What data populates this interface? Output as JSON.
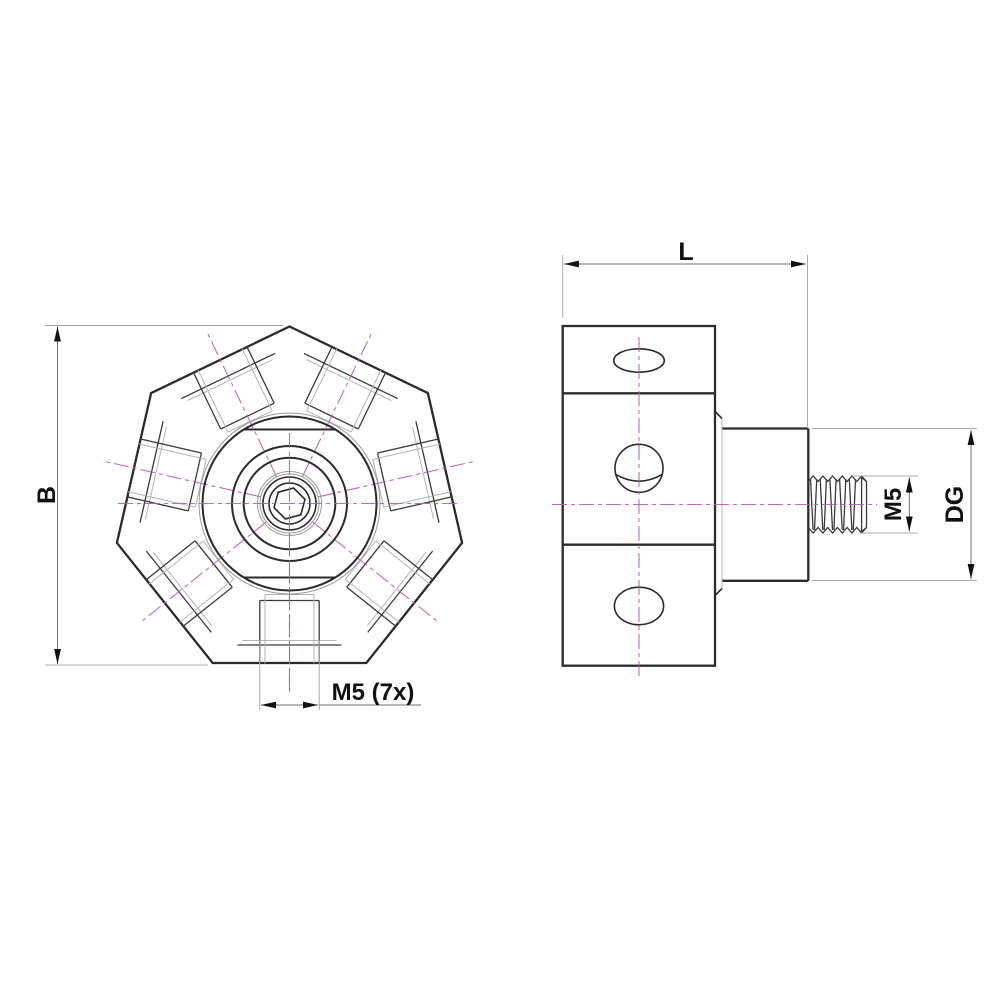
{
  "drawing": {
    "type": "technical-drawing",
    "part": {
      "front_view_shape": "heptagon",
      "radial_hole_count": 7,
      "side_view_sections": 3
    },
    "labels": {
      "height": "B",
      "length": "L",
      "radial_holes": "M5 (7x)",
      "stud_thread": "M5",
      "boss_diameter": "DG"
    },
    "colors": {
      "outline": "#2b2b2b",
      "centerline": "#b45cb4",
      "dimension_line": "#6e6e6e",
      "extension_line": "#ababab",
      "label": "#111111",
      "background": "#ffffff"
    }
  }
}
